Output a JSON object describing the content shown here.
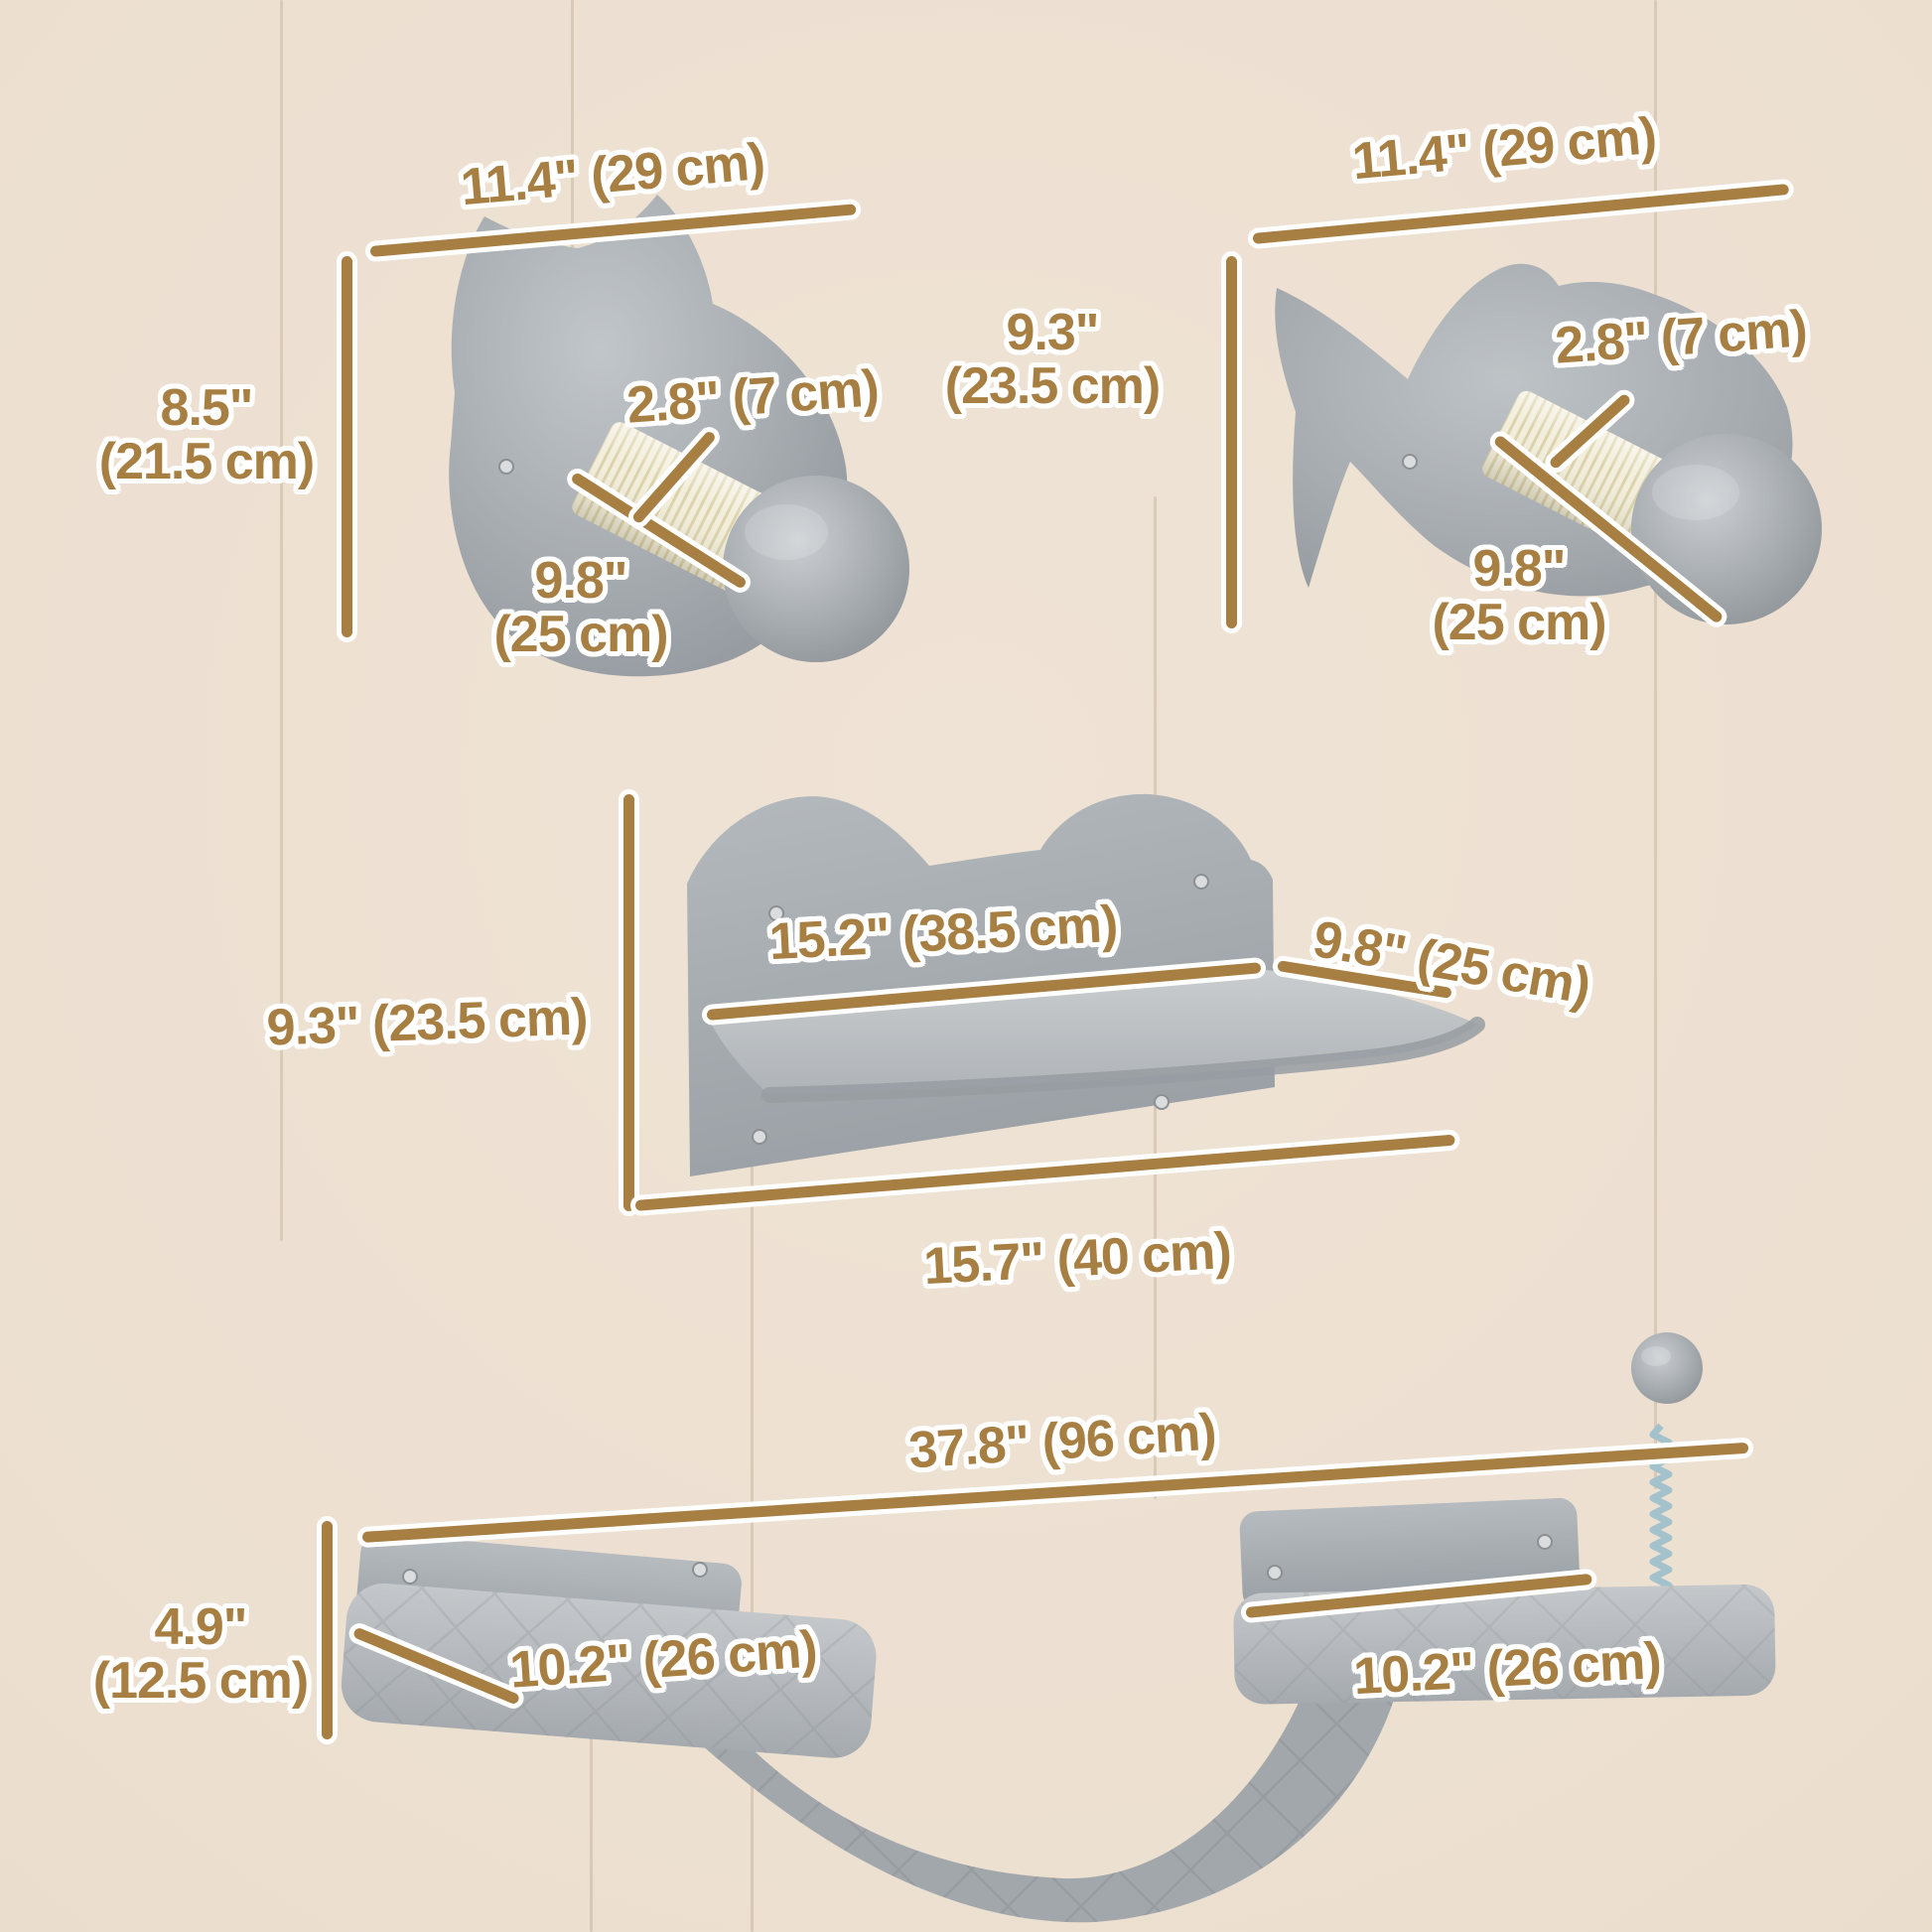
{
  "page": {
    "title": "cat wall furniture dimension diagram",
    "background_color": "#ecdfd0",
    "accent_color": "#a87f42",
    "outline_color": "#ffffff",
    "plush_color": "#a9aeb3",
    "sisal_color": "#f2eedb",
    "spring_color": "#a3c2cc"
  },
  "products": [
    {
      "id": "cat-head-scratcher",
      "label": "cat head shaped wall scratching post",
      "dimensions": {
        "width": "11.4\" (29 cm)",
        "height_in": "8.5\"",
        "height_cm": "(21.5 cm)",
        "post_diameter": "2.8\" (7 cm)",
        "post_length_in": "9.8\"",
        "post_length_cm": "(25 cm)"
      }
    },
    {
      "id": "fish-scratcher",
      "label": "fish shaped wall scratching post",
      "dimensions": {
        "width": "11.4\" (29 cm)",
        "height_in": "9.3\"",
        "height_cm": "(23.5 cm)",
        "post_diameter": "2.8\" (7 cm)",
        "post_length_in": "9.8\"",
        "post_length_cm": "(25 cm)"
      }
    },
    {
      "id": "cat-ear-shelf",
      "label": "cat ear wall shelf",
      "dimensions": {
        "height": "9.3\" (23.5 cm)",
        "shelf_width": "15.2\" (38.5 cm)",
        "shelf_depth": "9.8\" (25 cm)",
        "overall_width": "15.7\" (40 cm)"
      }
    },
    {
      "id": "shelf-bridge-set",
      "label": "wall shelves with hammock bridge and spring toy",
      "dimensions": {
        "overall_width": "37.8\" (96 cm)",
        "height_in": "4.9\"",
        "height_cm": "(12.5 cm)",
        "left_shelf_depth": "10.2\" (26 cm)",
        "right_shelf_width": "10.2\" (26 cm)"
      }
    }
  ]
}
